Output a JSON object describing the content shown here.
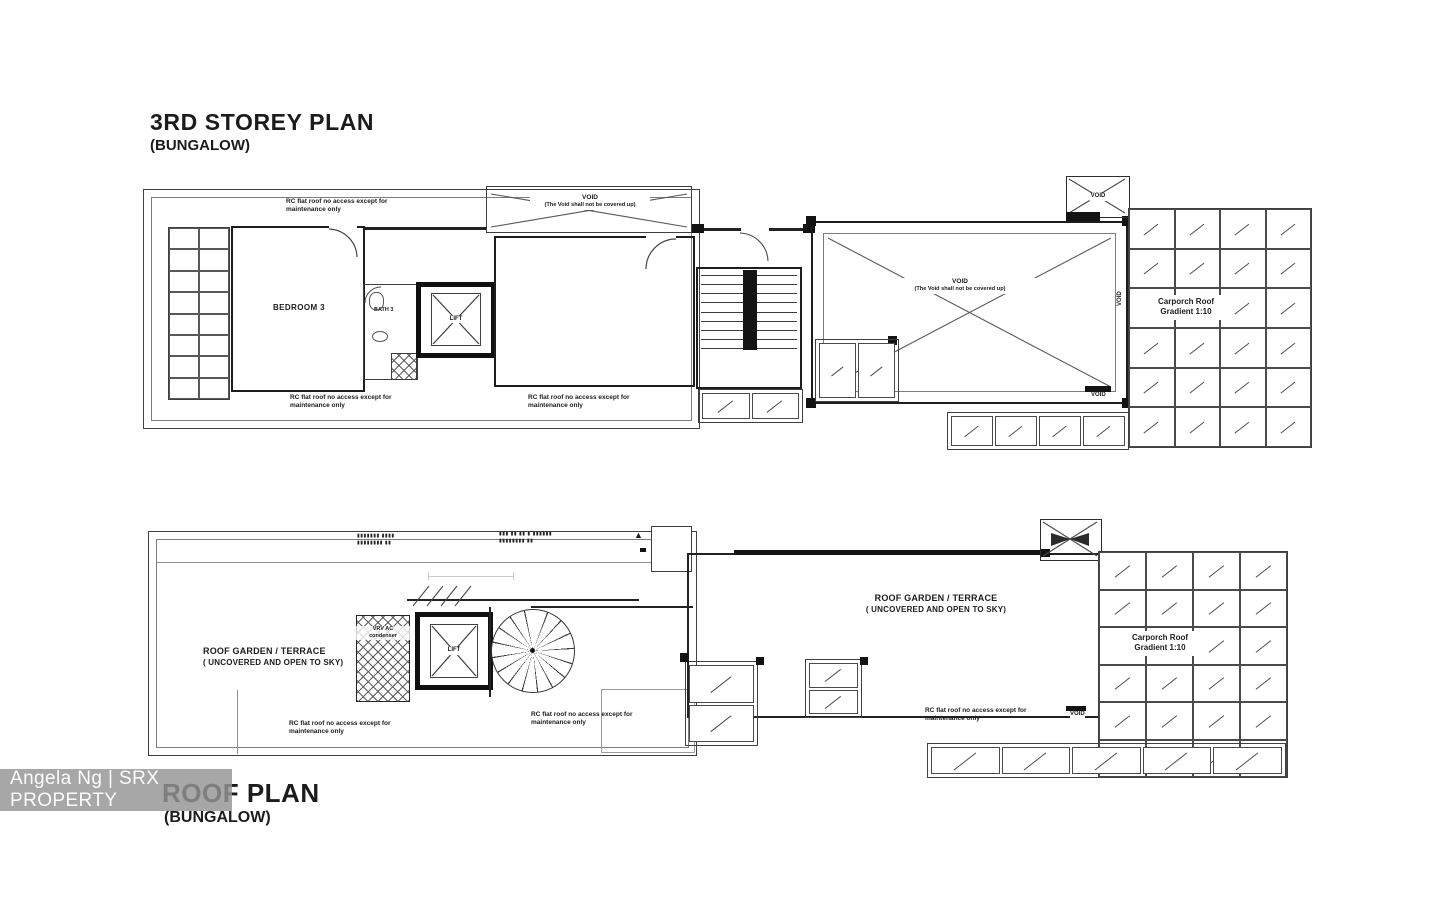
{
  "watermark": {
    "text": "Angela Ng | SRX PROPERTY"
  },
  "colors": {
    "line": "#3f3f3f",
    "wall": "#1d1d1d",
    "watermark_bg": "#949494",
    "watermark_text": "#ffffff"
  },
  "storey_plan": {
    "title": "3RD STOREY PLAN",
    "subtitle": "(BUNGALOW)",
    "labels": {
      "bedroom": "BEDROOM 3",
      "bath": "BATH 3",
      "lift": "LIFT",
      "void": "VOID",
      "void_note": "(The Void shall not be covered up)",
      "rc_note_line1": "RC flat roof no access except for",
      "rc_note_line2": "maintenance only",
      "carporch_line1": "Carporch Roof",
      "carporch_line2": "Gradient 1:10"
    }
  },
  "roof_plan": {
    "title": "ROOF PLAN",
    "subtitle": "(BUNGALOW)",
    "labels": {
      "garden_line1": "ROOF GARDEN / TERRACE",
      "garden_line2": "( UNCOVERED AND OPEN TO SKY)",
      "vrv_line1": "VRV AC",
      "vrv_line2": "condenser",
      "lift": "LIFT",
      "void": "VOID",
      "rc_note_line1": "RC flat roof no access except for",
      "rc_note_line2": "maintenance only",
      "carporch_line1": "Carporch Roof",
      "carporch_line2": "Gradient 1:10",
      "illegible_note1_line1": "▮▮▮▮▮▮▮ ▮▮▮▮",
      "illegible_note1_line2": "▮▮▮▮▮▮▮▮ ▮▮",
      "illegible_note2_line1": "▮▮▮ ▮▮ ▮▮ ▮ ▮▮▮▮▮▮",
      "illegible_note2_line2": "▮▮▮▮▮▮▮▮ ▮▮",
      "marker_triangle": "▲"
    }
  }
}
